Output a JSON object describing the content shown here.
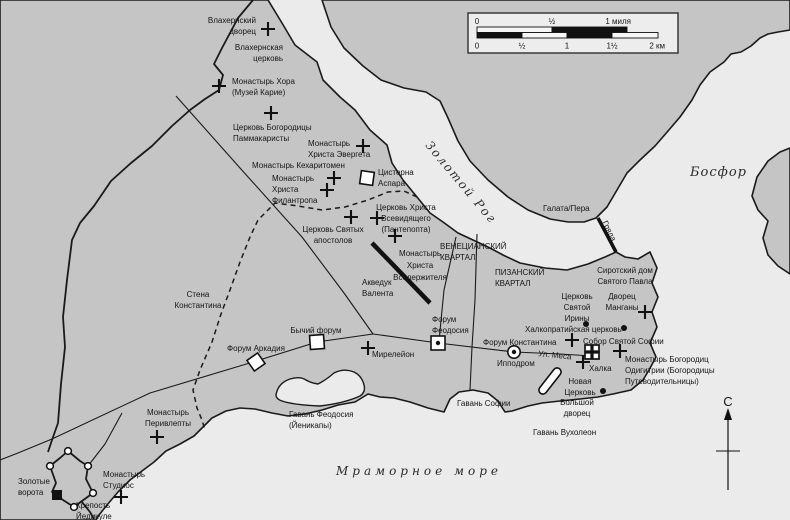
{
  "map": {
    "compass": {
      "label": "С"
    },
    "scale_bar": {
      "mi": [
        "0",
        "½",
        "1 миля"
      ],
      "km": [
        "0",
        "½",
        "1",
        "1½",
        "2 км"
      ]
    },
    "colors": {
      "land": "#c5c5c5",
      "water": "#ebebeb",
      "line": "#1a1a1a"
    },
    "labels": [
      {
        "id": "vlakhernsky-palace",
        "lines": [
          "Влахернский",
          "дворец"
        ],
        "x": 256,
        "y": 23,
        "anchor": "end"
      },
      {
        "id": "vlakhernskaya-church",
        "lines": [
          "Влахернская",
          "церковь"
        ],
        "x": 283,
        "y": 50,
        "anchor": "end"
      },
      {
        "id": "chora-monastery",
        "lines": [
          "Монастырь Хора",
          "(Музей Карие)"
        ],
        "x": 232,
        "y": 84,
        "anchor": "start"
      },
      {
        "id": "pammakaristos-church",
        "lines": [
          "Церковь Богородицы",
          "Паммакаристы"
        ],
        "x": 233,
        "y": 130,
        "anchor": "start"
      },
      {
        "id": "evergetes-monastery",
        "lines": [
          "Монастырь",
          "Христа Эвергета"
        ],
        "x": 308,
        "y": 146,
        "anchor": "start"
      },
      {
        "id": "kecharitomene-monastery",
        "lines": [
          "Монастырь Кехаритомен"
        ],
        "x": 252,
        "y": 168,
        "anchor": "start"
      },
      {
        "id": "philanthropos-monastery",
        "lines": [
          "Монастырь",
          "Христа",
          "Филантропа"
        ],
        "x": 272,
        "y": 181,
        "anchor": "start"
      },
      {
        "id": "cisterna-aspar",
        "lines": [
          "Цистерна",
          "Аспара"
        ],
        "x": 378,
        "y": 175,
        "anchor": "start"
      },
      {
        "id": "pantepoptes-church",
        "lines": [
          "Церковь Христа",
          "Всевидящего",
          "(Пантепопта)"
        ],
        "x": 406,
        "y": 210,
        "anchor": "middle"
      },
      {
        "id": "holy-apostles-church",
        "lines": [
          "Церковь Святых",
          "апостолов"
        ],
        "x": 333,
        "y": 232,
        "anchor": "middle"
      },
      {
        "id": "pantokrator-monastery",
        "lines": [
          "Монастырь",
          "Христа",
          "Вседержителя"
        ],
        "x": 420,
        "y": 256,
        "anchor": "middle",
        "lh": 12
      },
      {
        "id": "aqueduct-valens",
        "lines": [
          "Акведук",
          "Валента"
        ],
        "x": 362,
        "y": 285,
        "anchor": "start"
      },
      {
        "id": "venetian-quarter",
        "lines": [
          "ВЕНЕЦИАНСКИЙ",
          "КВАРТАЛ"
        ],
        "x": 440,
        "y": 249,
        "anchor": "start"
      },
      {
        "id": "pisan-quarter",
        "lines": [
          "ПИЗАНСКИЙ",
          "КВАРТАЛ"
        ],
        "x": 495,
        "y": 275,
        "anchor": "start"
      },
      {
        "id": "orphanage-st-paul",
        "lines": [
          "Сиротский дом",
          "Святого Павла"
        ],
        "x": 625,
        "y": 273,
        "anchor": "middle"
      },
      {
        "id": "st-irene-church",
        "lines": [
          "Церковь",
          "Святой",
          "Ирины"
        ],
        "x": 577,
        "y": 299,
        "anchor": "middle"
      },
      {
        "id": "mangana-palace",
        "lines": [
          "Дворец",
          "Манганы"
        ],
        "x": 622,
        "y": 299,
        "anchor": "middle"
      },
      {
        "id": "chalkoprateia-church",
        "lines": [
          "Халкопратийская церковь"
        ],
        "x": 525,
        "y": 332,
        "anchor": "start"
      },
      {
        "id": "hagia-sophia",
        "lines": [
          "Собор Святой Софии"
        ],
        "x": 583,
        "y": 344,
        "anchor": "start"
      },
      {
        "id": "forum-constantine",
        "lines": [
          "Форум Константина"
        ],
        "x": 483,
        "y": 345,
        "anchor": "start"
      },
      {
        "id": "mesa-street",
        "lines": [
          "Ул. Меса"
        ],
        "x": 538,
        "y": 356,
        "anchor": "start",
        "rotate": 6
      },
      {
        "id": "hippodrome",
        "lines": [
          "Ипподром"
        ],
        "x": 497,
        "y": 366,
        "anchor": "start"
      },
      {
        "id": "chalke",
        "lines": [
          "Халка"
        ],
        "x": 589,
        "y": 371,
        "anchor": "start"
      },
      {
        "id": "hodegetria-monastery",
        "lines": [
          "Монастырь Богородиц",
          "Одигитрии (Богородицы",
          "Путеводительницы)"
        ],
        "x": 625,
        "y": 362,
        "anchor": "start"
      },
      {
        "id": "nea-church",
        "lines": [
          "Новая",
          "Церковь"
        ],
        "x": 580,
        "y": 384,
        "anchor": "middle"
      },
      {
        "id": "great-palace",
        "lines": [
          "Большой",
          "дворец"
        ],
        "x": 577,
        "y": 405,
        "anchor": "middle"
      },
      {
        "id": "bucoleon-harbor",
        "lines": [
          "Гавань Вухолеон"
        ],
        "x": 533,
        "y": 435,
        "anchor": "start"
      },
      {
        "id": "sophia-harbor",
        "lines": [
          "Гавань Софии"
        ],
        "x": 457,
        "y": 406,
        "anchor": "start"
      },
      {
        "id": "theodosius-harbor",
        "lines": [
          "Гавань Феодосия",
          "(Йеникапы)"
        ],
        "x": 289,
        "y": 417,
        "anchor": "start"
      },
      {
        "id": "peribleptos-monastery",
        "lines": [
          "Монастырь",
          "Перивлепты"
        ],
        "x": 168,
        "y": 415,
        "anchor": "middle"
      },
      {
        "id": "studios-monastery",
        "lines": [
          "Монастырь",
          "Студиос"
        ],
        "x": 103,
        "y": 477,
        "anchor": "start"
      },
      {
        "id": "golden-gate",
        "lines": [
          "Золотые",
          "ворота"
        ],
        "x": 18,
        "y": 484,
        "anchor": "start"
      },
      {
        "id": "yedikule-fortress",
        "lines": [
          "Крепость",
          "Йедикуле"
        ],
        "x": 76,
        "y": 508,
        "anchor": "start"
      },
      {
        "id": "constantine-wall",
        "lines": [
          "Стена",
          "Константина"
        ],
        "x": 198,
        "y": 297,
        "anchor": "middle"
      },
      {
        "id": "bull-forum",
        "lines": [
          "Бычий форум"
        ],
        "x": 316,
        "y": 333,
        "anchor": "middle"
      },
      {
        "id": "arcadius-forum",
        "lines": [
          "Форум Аркадия"
        ],
        "x": 256,
        "y": 351,
        "anchor": "middle"
      },
      {
        "id": "myrelaion",
        "lines": [
          "Мирелейон"
        ],
        "x": 372,
        "y": 357,
        "anchor": "start"
      },
      {
        "id": "theodosius-forum",
        "lines": [
          "Форум",
          "Феодосия"
        ],
        "x": 432,
        "y": 322,
        "anchor": "start"
      },
      {
        "id": "galata-pera",
        "lines": [
          "Галата/Пера"
        ],
        "x": 543,
        "y": 211,
        "anchor": "start"
      },
      {
        "id": "chain",
        "lines": [
          "Гряда"
        ],
        "x": 607,
        "y": 232,
        "anchor": "middle",
        "rotate": 64
      },
      {
        "id": "golden-horn",
        "lines": [
          "Золотой Рог"
        ],
        "x": 458,
        "y": 185,
        "anchor": "middle",
        "cls": "water",
        "rotate": 50
      },
      {
        "id": "bosphorus",
        "lines": [
          "Босфор"
        ],
        "x": 690,
        "y": 176,
        "anchor": "start",
        "cls": "water-lg"
      },
      {
        "id": "marmara-sea",
        "lines": [
          "Мраморное море"
        ],
        "x": 419,
        "y": 475,
        "anchor": "middle",
        "cls": "water-sp"
      }
    ],
    "markers": [
      {
        "t": "cross",
        "id": "vlakhernsky-palace",
        "x": 268,
        "y": 29
      },
      {
        "t": "cross",
        "id": "chora-monastery",
        "x": 219,
        "y": 86
      },
      {
        "t": "cross",
        "id": "pammakaristos-church",
        "x": 271,
        "y": 113
      },
      {
        "t": "cross",
        "id": "evergetes-monastery",
        "x": 363,
        "y": 146
      },
      {
        "t": "cross",
        "id": "kecharitomene-monastery",
        "x": 334,
        "y": 178
      },
      {
        "t": "cross",
        "id": "philanthropos-monastery",
        "x": 327,
        "y": 190
      },
      {
        "t": "cross",
        "id": "holy-apostles-church",
        "x": 351,
        "y": 217
      },
      {
        "t": "cross",
        "id": "pantepoptes-church",
        "x": 377,
        "y": 218
      },
      {
        "t": "cross",
        "id": "pantokrator-monastery",
        "x": 395,
        "y": 236
      },
      {
        "t": "cross",
        "id": "myrelaion",
        "x": 368,
        "y": 348
      },
      {
        "t": "cross",
        "id": "peribleptos-monastery",
        "x": 157,
        "y": 437
      },
      {
        "t": "cross",
        "id": "studios-monastery",
        "x": 121,
        "y": 497
      },
      {
        "t": "cross",
        "id": "hagia-sophia",
        "x": 572,
        "y": 340
      },
      {
        "t": "cross",
        "id": "mangana-palace",
        "x": 645,
        "y": 312
      },
      {
        "t": "cross",
        "id": "chalke",
        "x": 583,
        "y": 362
      },
      {
        "t": "cross",
        "id": "hodegetria-monastery",
        "x": 620,
        "y": 351
      },
      {
        "t": "dot",
        "id": "st-irene-church",
        "x": 586,
        "y": 324
      },
      {
        "t": "dot",
        "id": "chalkoprateia-church",
        "x": 624,
        "y": 328
      },
      {
        "t": "dot",
        "id": "nea-church",
        "x": 603,
        "y": 391
      },
      {
        "t": "square",
        "id": "cisterna-aspar",
        "x": 367,
        "y": 178,
        "s": 13,
        "rot": 8
      },
      {
        "t": "square",
        "id": "bull-forum",
        "x": 317,
        "y": 342,
        "s": 14,
        "rot": -4
      },
      {
        "t": "square",
        "id": "arcadius-forum",
        "x": 256,
        "y": 362,
        "s": 13,
        "rot": -35
      },
      {
        "t": "square-dot",
        "id": "theodosius-forum",
        "x": 438,
        "y": 343,
        "s": 14,
        "rot": 0
      },
      {
        "t": "circle-dot",
        "id": "forum-constantine",
        "x": 514,
        "y": 352
      },
      {
        "t": "church-icon",
        "id": "hagia-sophia-icon",
        "x": 592,
        "y": 352,
        "s": 14
      },
      {
        "t": "black-square",
        "id": "yedikule-marker",
        "x": 57,
        "y": 495,
        "s": 10
      },
      {
        "t": "hippo",
        "id": "hippodrome-track",
        "x": 550,
        "y": 381,
        "w": 31,
        "h": 8,
        "rot": -52
      },
      {
        "t": "tower",
        "id": "fortress-tower",
        "x": 68,
        "y": 451
      },
      {
        "t": "tower",
        "id": "fortress-tower",
        "x": 88,
        "y": 466
      },
      {
        "t": "tower",
        "id": "fortress-tower",
        "x": 93,
        "y": 493
      },
      {
        "t": "tower",
        "id": "fortress-tower",
        "x": 74,
        "y": 507
      },
      {
        "t": "tower",
        "id": "fortress-tower",
        "x": 50,
        "y": 466
      }
    ]
  }
}
